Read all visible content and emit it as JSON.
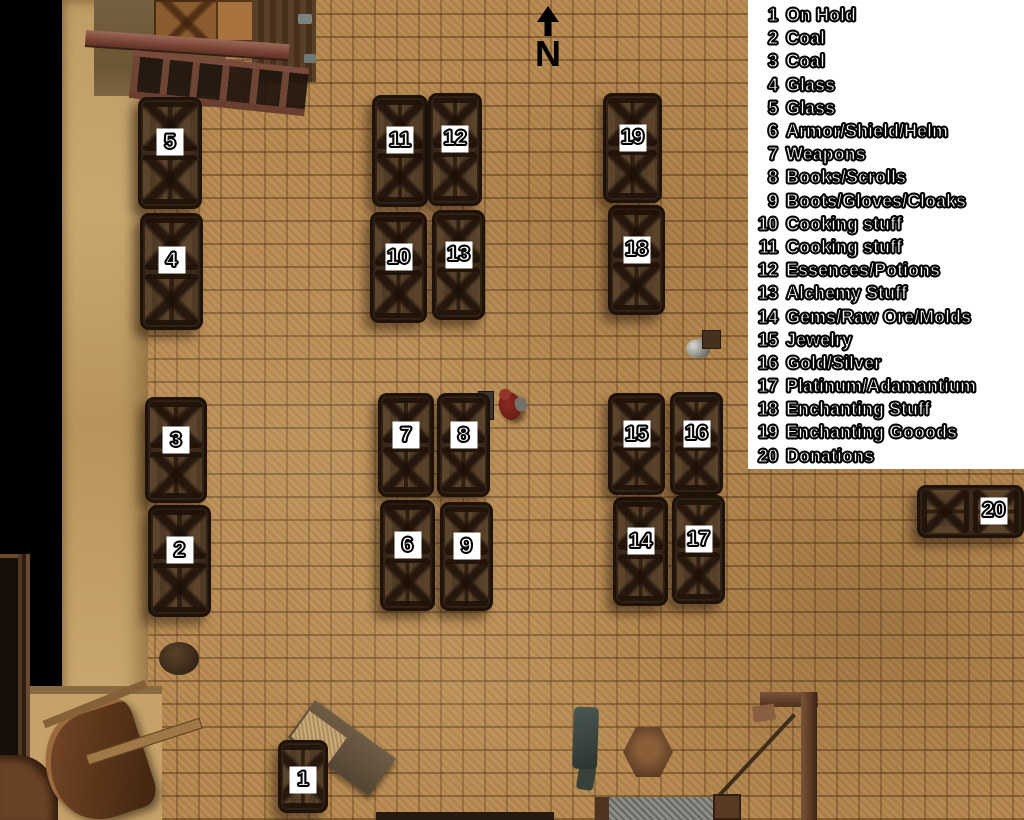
{
  "legend": {
    "items": [
      {
        "num": "1",
        "label": "On Hold"
      },
      {
        "num": "2",
        "label": "Coal"
      },
      {
        "num": "3",
        "label": "Coal"
      },
      {
        "num": "4",
        "label": "Glass"
      },
      {
        "num": "5",
        "label": "Glass"
      },
      {
        "num": "6",
        "label": "Armor/Shield/Helm"
      },
      {
        "num": "7",
        "label": "Weapons"
      },
      {
        "num": "8",
        "label": "Books/Scrolls"
      },
      {
        "num": "9",
        "label": "Boots/Gloves/Cloaks"
      },
      {
        "num": "10",
        "label": "Cooking stuff"
      },
      {
        "num": "11",
        "label": "Cooking stuff"
      },
      {
        "num": "12",
        "label": "Essences/Potions"
      },
      {
        "num": "13",
        "label": "Alchemy Stuff"
      },
      {
        "num": "14",
        "label": "Gems/Raw Ore/Molds"
      },
      {
        "num": "15",
        "label": "Jewelry"
      },
      {
        "num": "16",
        "label": "Gold/Silver"
      },
      {
        "num": "17",
        "label": "Platinum/Adamantium"
      },
      {
        "num": "18",
        "label": "Enchanting Stuff"
      },
      {
        "num": "19",
        "label": "Enchanting Gooods"
      },
      {
        "num": "20",
        "label": "Donations"
      }
    ]
  },
  "compass": {
    "label": "N",
    "icon": "north-arrow-icon"
  },
  "map": {
    "chests": [
      {
        "num": "1",
        "x": 278,
        "y": 740,
        "w": 50,
        "h": 73,
        "panels": 1,
        "label_y": 55
      },
      {
        "num": "2",
        "x": 148,
        "y": 505,
        "w": 63,
        "h": 112,
        "panels": 2
      },
      {
        "num": "3",
        "x": 145,
        "y": 397,
        "w": 62,
        "h": 106,
        "panels": 2
      },
      {
        "num": "4",
        "x": 140,
        "y": 213,
        "w": 63,
        "h": 117,
        "panels": 2
      },
      {
        "num": "5",
        "x": 138,
        "y": 97,
        "w": 64,
        "h": 112,
        "panels": 2
      },
      {
        "num": "6",
        "x": 380,
        "y": 500,
        "w": 55,
        "h": 111,
        "panels": 2
      },
      {
        "num": "7",
        "x": 378,
        "y": 393,
        "w": 56,
        "h": 104,
        "panels": 2
      },
      {
        "num": "8",
        "x": 437,
        "y": 393,
        "w": 53,
        "h": 104,
        "panels": 2
      },
      {
        "num": "9",
        "x": 440,
        "y": 502,
        "w": 53,
        "h": 109,
        "panels": 2
      },
      {
        "num": "10",
        "x": 370,
        "y": 212,
        "w": 57,
        "h": 111,
        "panels": 2
      },
      {
        "num": "11",
        "x": 372,
        "y": 95,
        "w": 56,
        "h": 112,
        "panels": 2
      },
      {
        "num": "12",
        "x": 428,
        "y": 93,
        "w": 54,
        "h": 113,
        "panels": 2
      },
      {
        "num": "13",
        "x": 432,
        "y": 210,
        "w": 53,
        "h": 110,
        "panels": 2
      },
      {
        "num": "14",
        "x": 613,
        "y": 497,
        "w": 55,
        "h": 109,
        "panels": 2
      },
      {
        "num": "15",
        "x": 608,
        "y": 393,
        "w": 57,
        "h": 102,
        "panels": 2
      },
      {
        "num": "16",
        "x": 670,
        "y": 392,
        "w": 53,
        "h": 103,
        "panels": 2
      },
      {
        "num": "17",
        "x": 672,
        "y": 495,
        "w": 53,
        "h": 109,
        "panels": 2
      },
      {
        "num": "18",
        "x": 608,
        "y": 205,
        "w": 57,
        "h": 110,
        "panels": 2
      },
      {
        "num": "19",
        "x": 603,
        "y": 93,
        "w": 59,
        "h": 110,
        "panels": 2
      },
      {
        "num": "20",
        "x": 917,
        "y": 485,
        "w": 107,
        "h": 53,
        "panels": 2,
        "horizontal": true,
        "label_x": 73,
        "label_y": 48
      }
    ],
    "player": {
      "x": 499,
      "y": 392
    }
  },
  "colors": {
    "floor": "#b5884f",
    "chest_wood": "#4e3827",
    "legend_bg": "#ffffff",
    "void": "#000000",
    "rug_green": "#0f6a2c"
  }
}
